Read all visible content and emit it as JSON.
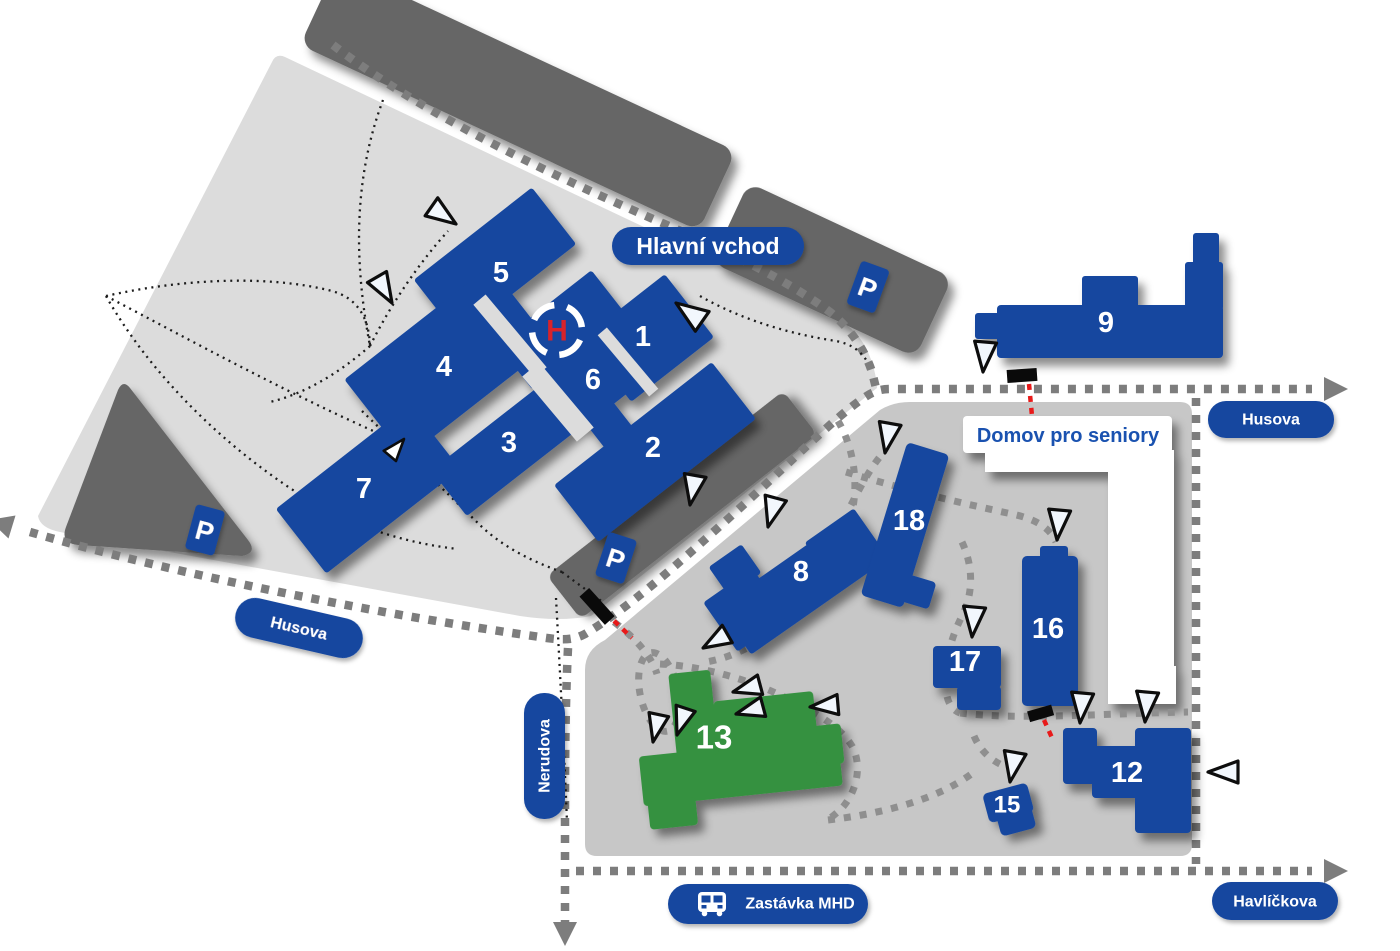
{
  "labels": {
    "main_entrance": "Hlavní vchod",
    "senior_home": "Domov pro seniory",
    "bus_stop": "Zastávka MHD",
    "parking": "P",
    "helipad": "H"
  },
  "streets": {
    "husova": "Husova",
    "nerudova": "Nerudova",
    "havlickova": "Havlíčkova"
  },
  "buildings": {
    "b1": "1",
    "b2": "2",
    "b3": "3",
    "b4": "4",
    "b5": "5",
    "b6": "6",
    "b7": "7",
    "b8": "8",
    "b9": "9",
    "b12": "12",
    "b13": "13",
    "b15": "15",
    "b16": "16",
    "b17": "17",
    "b18": "18"
  },
  "colors": {
    "building_blue": "#16479f",
    "building_green": "#36913f",
    "campus_light": "#dcdcdc",
    "campus_mid": "#c7c7c7",
    "dark_structure": "#666666",
    "road_dash": "#7d7d7d",
    "path_dash": "#8f8f8f",
    "foot_dot": "#1c1c1c",
    "gate_red": "#e81a1a",
    "helipad_red": "#d8232a",
    "domov_text": "#1a52b0"
  }
}
